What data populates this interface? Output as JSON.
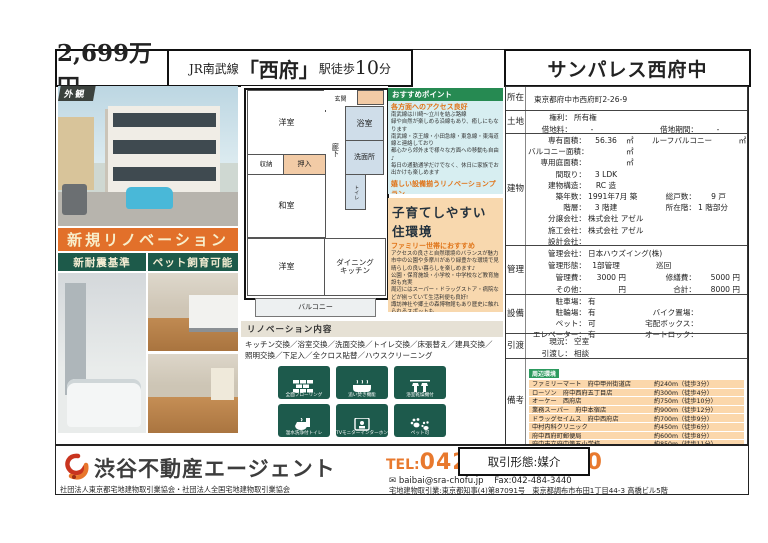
{
  "header": {
    "price": "2,699万円",
    "station_pre": "JR南武線",
    "station_name": "「西府」",
    "station_mid": "駅徒歩",
    "station_min": "10",
    "station_suf": "分",
    "property_name": "サンパレス西府中"
  },
  "photos": {
    "exterior_label": "外観",
    "banner_renovation": "新規リノベーション",
    "banner_earthquake": "新耐震基準",
    "banner_pet": "ペット飼育可能"
  },
  "floorplan": {
    "entrance": "玄関",
    "western1": "洋室",
    "bath": "浴室",
    "hallway": "廊下",
    "washroom": "洗面所",
    "storage": "収納",
    "closet": "押入",
    "japanese": "和室",
    "toilet": "トイレ",
    "western2": "洋室",
    "dining_kitchen": "ダイニング\nキッチン",
    "balcony": "バルコニー"
  },
  "points": {
    "title": "おすすめポイント",
    "sub1": "各方面へのアクセス良好",
    "s1l0": "南武線は川崎～立川を結ぶ路線",
    "s1l1": "緑や自然が楽しめる沿線もあり、癒しにもなります",
    "s1l2": "南武線・京王線・小田急線・東急線・東海道線と連絡しており",
    "s1l3": "都心から郊外まで様々な方面への移動も自由♪",
    "s1l4": "毎日の通勤通学だけでなく、休日に家族でお出かけも楽しめます",
    "sub2": "嬉しい設備揃うリノベーションプラン",
    "s2l0": "住む人のことを考えた設備一新リノベーション",
    "s2l1": "全面フローリングで高級感のある仕上がりに",
    "s2l2": "時間のずれた入浴でも安心の浴室乾燥・追い焚き機能が標準装備",
    "s2l3": "収納スペース豊富でスッキリ綺麗な住環境が実現可能"
  },
  "family": {
    "title": "子育てしやすい住環境",
    "subtitle": "ファミリー世帯におすすめ",
    "l0": "アクセスの良さと自然環境のバランスが魅力",
    "l1": "市中の公園や多摩川があり緑豊かな環境で見晴らしの良い暮らしを楽しめます♪",
    "l2": "公園・保育施設・小学校・中学校など教育施設も充実",
    "l3": "周辺にはスーパー・ドラッグストア・病院などが揃っていて生活利便も良好!",
    "l4": "諏訪神社や郷土の森博物館もあり歴史に触れられるスポットも",
    "l5": "開発が進み更に住みやすくなるでしょう♪"
  },
  "renovation": {
    "title": "リノベーション内容",
    "content": "キッチン交換／浴室交換／洗面交換／トイレ交換／床張替え／建具交換／照明交換／下足入／全クロス貼替／ハウスクリーニング"
  },
  "features": {
    "f0": "全面フローリング",
    "f1": "追い焚き機能",
    "f2": "浴室乾燥機付",
    "f3": "温水洗浄付トイレ",
    "f4": "TVモニターインターホン",
    "f5": "ペット可"
  },
  "spec": {
    "loc": {
      "tag": "所在",
      "address": "東京都府中市西府町2-26-9"
    },
    "land": {
      "tag": "土地",
      "rights_l": "権利：",
      "rights_v": "所有権",
      "rent_l": "借地料：",
      "rent_v": "-",
      "period_l": "借地期間：",
      "period_v": "-"
    },
    "bld": {
      "tag": "建物",
      "r1l": "専有面積：",
      "r1v": "56.36",
      "r1u": "㎡",
      "r1l2": "ルーフバルコニー",
      "r1u2": "㎡",
      "r2l": "バルコニー面積：",
      "r2v": "",
      "r2u": "㎡",
      "r3l": "専用庭面積：",
      "r3v": "",
      "r3u": "㎡",
      "r4l": "間取り：",
      "r4v": "3 LDK",
      "r5l": "建物構造：",
      "r5v": "RC 造",
      "r6l": "築年数：",
      "r6v": "1991年7月 築",
      "r6l2": "総戸数：",
      "r6v2": "9 戸",
      "r7l": "階層：",
      "r7v": "3 階建",
      "r7l2": "所在階：",
      "r7v2": "1 階部分",
      "r8l": "分譲会社：",
      "r8v": "株式会社 アゼル",
      "r9l": "施工会社：",
      "r9v": "株式会社 アゼル",
      "r10l": "設計会社：",
      "r10v": ""
    },
    "mgmt": {
      "tag": "管理",
      "r1l": "管理会社：",
      "r1v": "日本ハウズイング(株)",
      "r2l": "管理形態：",
      "r2v": "1部管理",
      "r2v2": "巡回",
      "r3l": "管理費：",
      "r3v": "3000 円",
      "r3l2": "修繕費：",
      "r3v2": "5000 円",
      "r4l": "その他：",
      "r4v": "円",
      "r4l2": "合計：",
      "r4v2": "8000 円"
    },
    "equip": {
      "tag": "設備",
      "r1l": "駐車場：",
      "r1v": "有",
      "r2l": "駐輪場：",
      "r2v": "有",
      "r2l2": "バイク置場：",
      "r2v2": "",
      "r3l": "ペット：",
      "r3v": "可",
      "r3l2": "宅配ボックス：",
      "r3v2": "",
      "r4l": "エレベーター：",
      "r4v": "有",
      "r4l2": "オートロック：",
      "r4v2": ""
    },
    "hand": {
      "tag": "引渡",
      "r1l": "現況：",
      "r1v": "空室",
      "r2l": "引渡し：",
      "r2v": "相談"
    },
    "notes": {
      "tag": "備考",
      "env_tag": "周辺環境",
      "items": [
        {
          "n": "ファミリーマート　府中甲州街道店",
          "d": "約240m（徒歩3分）"
        },
        {
          "n": "ローソン　府中西府五丁目店",
          "d": "約300m（徒歩4分）"
        },
        {
          "n": "オーケー　西府店",
          "d": "約750m（徒歩10分）"
        },
        {
          "n": "業務スーパー　府中本宿店",
          "d": "約900m（徒歩12分）"
        },
        {
          "n": "ドラッグセイムス　府中西府店",
          "d": "約700m（徒歩9分）"
        },
        {
          "n": "中村内科クリニック",
          "d": "約450m（徒歩6分）"
        },
        {
          "n": "府中西府町郵便局",
          "d": "約600m（徒歩8分）"
        },
        {
          "n": "府中市立府中第五小学校",
          "d": "約850m（徒歩11分）"
        },
        {
          "n": "府中市立府中第十中学校",
          "d": "約400m（徒歩5分）"
        }
      ]
    }
  },
  "footer": {
    "company": "渋谷不動産エージェント",
    "assoc": "社団法人東京都宅地建物取引業協会・社団法人全国宅地建物取引業協会",
    "tel_label": "TEL:",
    "tel": "042-444-5950",
    "email_icon": "✉",
    "email": "baibai@sra-chofu.jp",
    "fax": "Fax:042-484-3440",
    "license": "宅地建物取引業:東京都知事(4)第87091号　東京都調布市布田1丁目44-3 高橋ビル5階",
    "deal_type": "取引形態:媒介"
  }
}
